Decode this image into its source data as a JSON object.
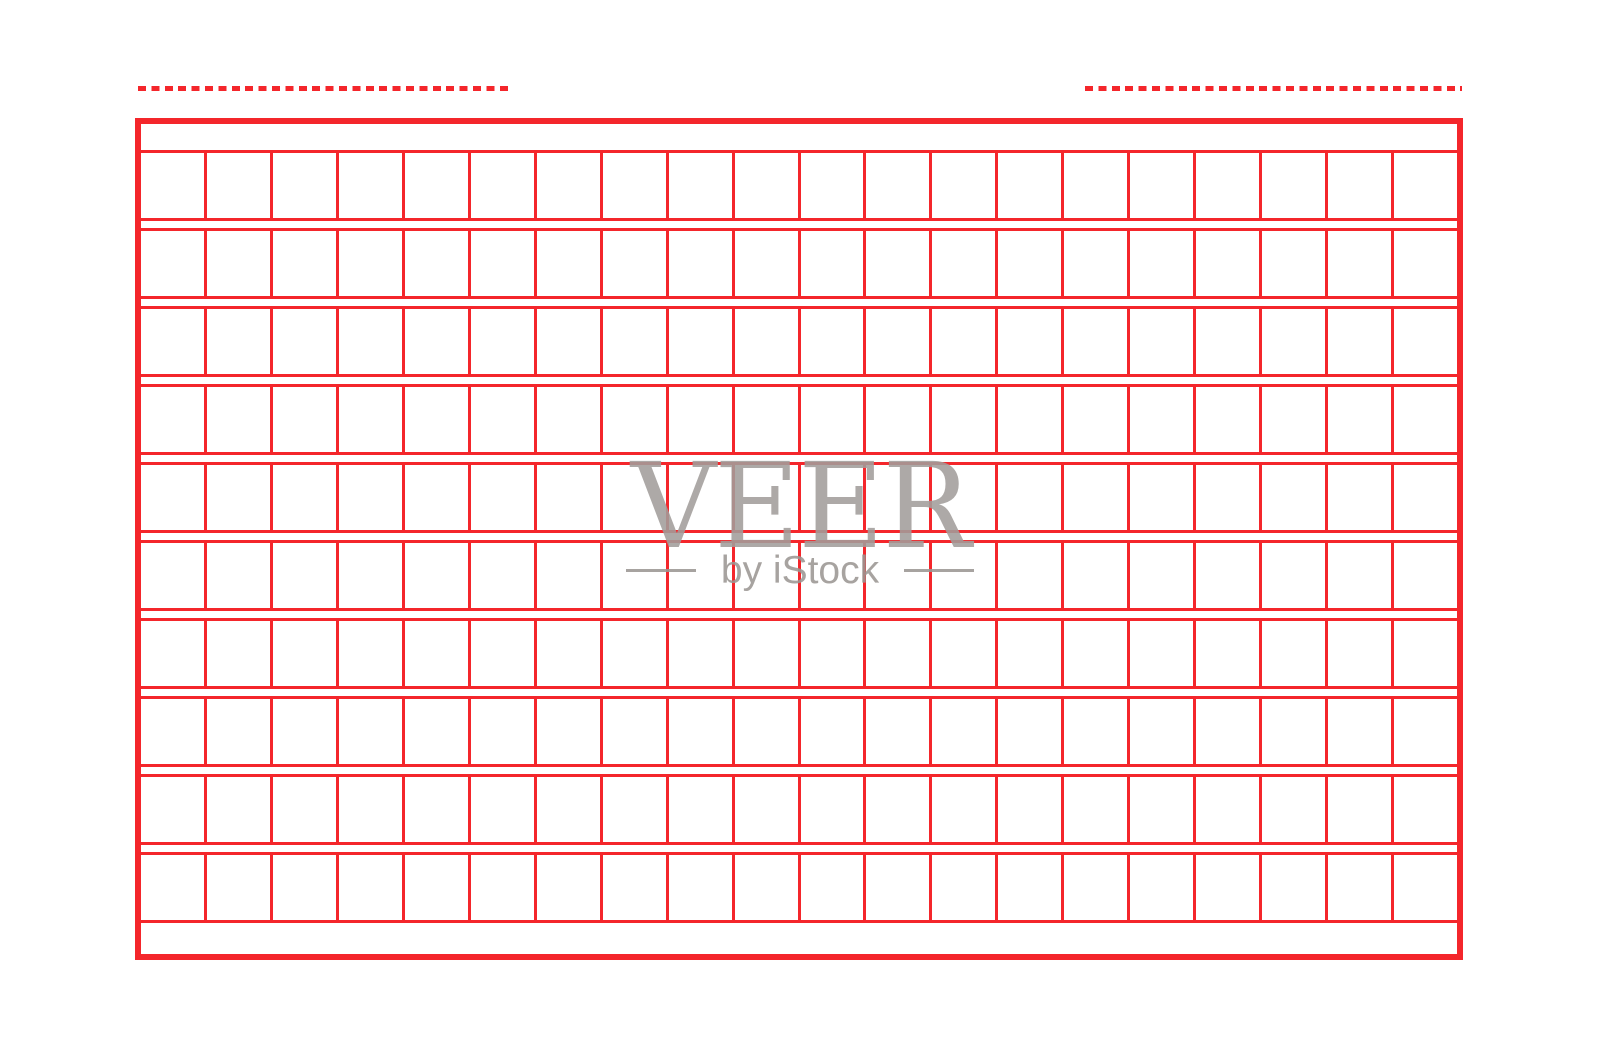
{
  "page": {
    "background": "#ffffff"
  },
  "colors": {
    "grid_red": "#f4262b",
    "watermark_gray": "#a29e9b",
    "watermark_subtitle_gray": "#9b9793"
  },
  "grid": {
    "rows": 10,
    "columns": 20
  },
  "decorations": {
    "top_dashed_lines": 2
  },
  "watermark": {
    "title": "VEER",
    "subtitle": "by iStock"
  }
}
